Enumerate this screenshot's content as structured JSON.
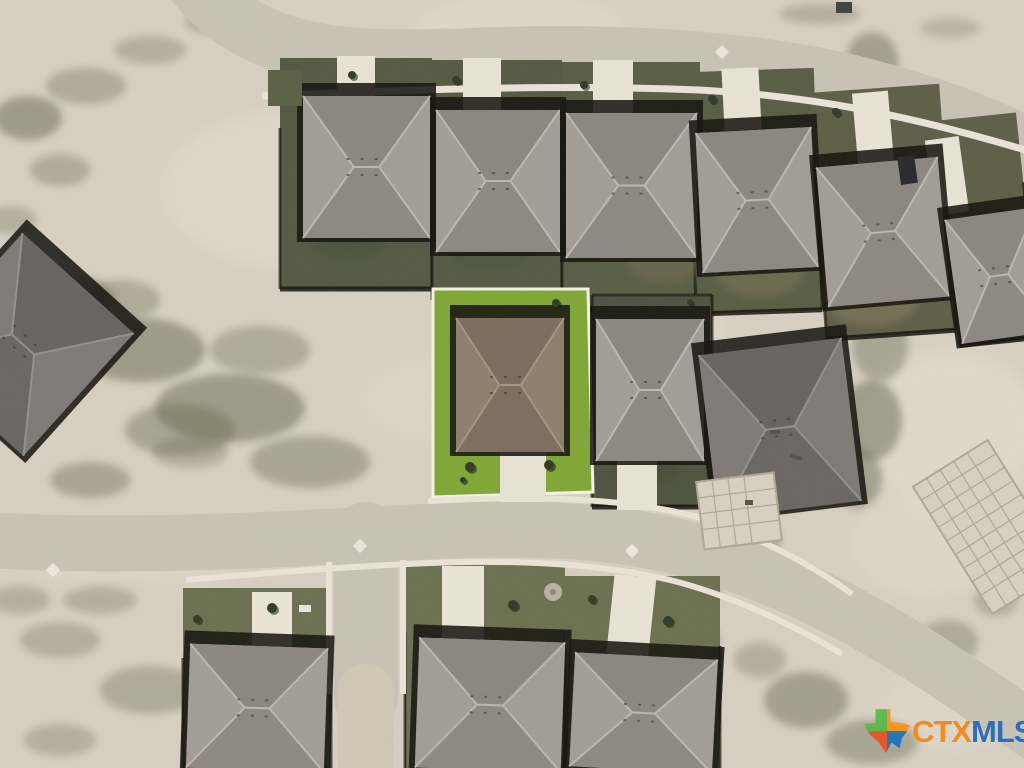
{
  "watermark": {
    "ctx": "CTX",
    "mls": "MLS",
    "ctx_color": "#f28a20",
    "mls_color": "#2e6fba",
    "logo": {
      "green": "#5cb848",
      "orange": "#f7941d",
      "blue": "#1b75bb",
      "red": "#ea5329"
    }
  },
  "palette": {
    "dirt": "#d7d0c3",
    "dirtLight": "#e9e3d6",
    "scrub": "#66664d",
    "road": "#c9c3b6",
    "walk": "#eae5d8",
    "drive": "#e9e4d6",
    "shadow": "#14130e",
    "lawnDark1": "#545942",
    "lawnDark2": "#575c43",
    "lawnDark3": "#5d5e46",
    "lawnMid": "#6b7050",
    "lawnA": "#4e5340",
    "lawnBright": "#7fa735",
    "lotOutline": "#f7f4ea",
    "slab": "#d8d1c3",
    "slabLine": "#b0a795"
  },
  "roofs": {
    "gray": {
      "base": "#a29e96",
      "facet": "#8b877f",
      "ridge": "#bcb8b0"
    },
    "grayDark": {
      "base": "#7e7a74",
      "facet": "#67635e",
      "ridge": "#94908a"
    },
    "brown": {
      "base": "#8f7e6d",
      "facet": "#7b6b5c",
      "ridge": "#a5947e"
    }
  },
  "scene": {
    "roads": [
      {
        "n": "street-top",
        "d": "M 185 -30 C 245 55 330 63 470 57 C 610 51 760 58 875 90 C 950 110 1010 135 1045 158",
        "w": 58,
        "c": "road"
      },
      {
        "n": "street-middle",
        "d": "M -12 540 C 120 548 260 541 420 532 C 560 524 650 534 730 562 C 810 590 880 628 950 675 C 1000 708 1022 723 1048 742",
        "w": 56,
        "c": "road"
      },
      {
        "n": "street-stub",
        "d": "M 366 534 L 366 698",
        "w": 64,
        "c": "road"
      },
      {
        "n": "street-stub-dirt",
        "d": "M 366 692 L 366 772",
        "w": 56,
        "c": "#d2c8b5"
      }
    ],
    "walks": [
      {
        "n": "sidewalk-top",
        "d": "M 262 96 C 400 90 560 84 700 90 C 810 96 905 114 1032 152",
        "w": 7
      },
      {
        "n": "sidewalk-mid-upper",
        "d": "M 428 501 C 560 494 660 500 730 528 C 780 548 822 572 852 594",
        "w": 6
      },
      {
        "n": "sidewalk-mid-lower",
        "d": "M 186 580 C 300 570 360 566 430 563 C 530 559 610 566 670 580 C 730 595 792 624 842 654",
        "w": 6
      },
      {
        "n": "sidewalk-stub-left",
        "d": "M 329 562 L 329 694",
        "w": 6
      },
      {
        "n": "sidewalk-stub-right",
        "d": "M 403 560 L 403 694",
        "w": 6
      }
    ],
    "lightPatches": [
      {
        "x": 300,
        "y": 190,
        "rx": 140,
        "ry": 80,
        "o": 0.45
      },
      {
        "x": 620,
        "y": 340,
        "rx": 110,
        "ry": 70,
        "o": 0.35
      },
      {
        "x": 520,
        "y": 30,
        "rx": 110,
        "ry": 36,
        "o": 0.4
      },
      {
        "x": 90,
        "y": 550,
        "rx": 70,
        "ry": 30,
        "o": 0.35
      },
      {
        "x": 950,
        "y": 710,
        "rx": 70,
        "ry": 40,
        "o": 0.35
      },
      {
        "x": 420,
        "y": 400,
        "rx": 60,
        "ry": 40,
        "o": 0.3
      },
      {
        "x": 180,
        "y": 560,
        "rx": 60,
        "ry": 24,
        "o": 0.3
      },
      {
        "x": 950,
        "y": 430,
        "rx": 90,
        "ry": 80,
        "o": 0.5
      },
      {
        "x": 930,
        "y": 545,
        "rx": 80,
        "ry": 50,
        "o": 0.4
      },
      {
        "x": 995,
        "y": 265,
        "rx": 40,
        "ry": 60,
        "o": 0.4
      }
    ],
    "scrub": [
      {
        "x": 28,
        "y": 118,
        "rx": 34,
        "ry": 22,
        "o": 0.5
      },
      {
        "x": 86,
        "y": 86,
        "rx": 40,
        "ry": 18,
        "o": 0.35
      },
      {
        "x": 150,
        "y": 50,
        "rx": 36,
        "ry": 14,
        "o": 0.3
      },
      {
        "x": 215,
        "y": 22,
        "rx": 30,
        "ry": 12,
        "o": 0.3
      },
      {
        "x": 60,
        "y": 170,
        "rx": 30,
        "ry": 16,
        "o": 0.35
      },
      {
        "x": 10,
        "y": 220,
        "rx": 26,
        "ry": 14,
        "o": 0.3
      },
      {
        "x": 60,
        "y": 300,
        "rx": 55,
        "ry": 26,
        "o": 0.45
      },
      {
        "x": 140,
        "y": 350,
        "rx": 65,
        "ry": 32,
        "o": 0.5
      },
      {
        "x": 230,
        "y": 408,
        "rx": 75,
        "ry": 34,
        "o": 0.5
      },
      {
        "x": 310,
        "y": 462,
        "rx": 60,
        "ry": 26,
        "o": 0.4
      },
      {
        "x": 120,
        "y": 300,
        "rx": 40,
        "ry": 20,
        "o": 0.35
      },
      {
        "x": 260,
        "y": 350,
        "rx": 50,
        "ry": 24,
        "o": 0.35
      },
      {
        "x": 180,
        "y": 430,
        "rx": 55,
        "ry": 26,
        "o": 0.4
      },
      {
        "x": 40,
        "y": 380,
        "rx": 35,
        "ry": 20,
        "o": 0.3
      },
      {
        "x": 90,
        "y": 480,
        "rx": 40,
        "ry": 18,
        "o": 0.4
      },
      {
        "x": 190,
        "y": 452,
        "rx": 38,
        "ry": 16,
        "o": 0.3
      },
      {
        "x": 820,
        "y": 14,
        "rx": 40,
        "ry": 10,
        "o": 0.3
      },
      {
        "x": 950,
        "y": 28,
        "rx": 30,
        "ry": 10,
        "o": 0.25
      },
      {
        "x": 872,
        "y": 62,
        "rx": 26,
        "ry": 30,
        "o": 0.45
      },
      {
        "x": 902,
        "y": 132,
        "rx": 24,
        "ry": 40,
        "o": 0.5
      },
      {
        "x": 928,
        "y": 205,
        "rx": 26,
        "ry": 38,
        "o": 0.45
      },
      {
        "x": 948,
        "y": 268,
        "rx": 24,
        "ry": 30,
        "o": 0.4
      },
      {
        "x": 880,
        "y": 345,
        "rx": 28,
        "ry": 36,
        "o": 0.4
      },
      {
        "x": 872,
        "y": 420,
        "rx": 30,
        "ry": 40,
        "o": 0.5
      },
      {
        "x": 856,
        "y": 478,
        "rx": 26,
        "ry": 30,
        "o": 0.45
      },
      {
        "x": 742,
        "y": 470,
        "rx": 18,
        "ry": 26,
        "o": 0.35
      },
      {
        "x": 760,
        "y": 540,
        "rx": 20,
        "ry": 22,
        "o": 0.4
      },
      {
        "x": 700,
        "y": 585,
        "rx": 22,
        "ry": 16,
        "o": 0.35
      },
      {
        "x": 806,
        "y": 700,
        "rx": 42,
        "ry": 28,
        "o": 0.45
      },
      {
        "x": 872,
        "y": 742,
        "rx": 46,
        "ry": 22,
        "o": 0.4
      },
      {
        "x": 948,
        "y": 642,
        "rx": 30,
        "ry": 22,
        "o": 0.35
      },
      {
        "x": 996,
        "y": 600,
        "rx": 22,
        "ry": 16,
        "o": 0.3
      },
      {
        "x": 760,
        "y": 660,
        "rx": 26,
        "ry": 18,
        "o": 0.3
      },
      {
        "x": 700,
        "y": 640,
        "rx": 20,
        "ry": 14,
        "o": 0.3
      },
      {
        "x": 60,
        "y": 640,
        "rx": 40,
        "ry": 18,
        "o": 0.3
      },
      {
        "x": 150,
        "y": 690,
        "rx": 50,
        "ry": 24,
        "o": 0.35
      },
      {
        "x": 60,
        "y": 740,
        "rx": 36,
        "ry": 16,
        "o": 0.3
      },
      {
        "x": 260,
        "y": 748,
        "rx": 40,
        "ry": 16,
        "o": 0.3
      },
      {
        "x": 20,
        "y": 600,
        "rx": 30,
        "ry": 14,
        "o": 0.3
      },
      {
        "x": 100,
        "y": 600,
        "rx": 36,
        "ry": 14,
        "o": 0.3
      }
    ],
    "lots": [
      {
        "n": "backyard-lot",
        "x": 280,
        "y": 58,
        "w": 152,
        "h": 231,
        "f": "lawnDark1",
        "fence": "sb"
      },
      {
        "n": "backyard-lot",
        "x": 432,
        "y": 60,
        "w": 130,
        "h": 240,
        "f": "lawnDark1",
        "fence": "sb"
      },
      {
        "n": "backyard-lot",
        "x": 562,
        "y": 62,
        "w": 138,
        "h": 248,
        "f": "lawnDark2",
        "fence": "sb"
      },
      {
        "n": "backyard-lot",
        "x": 692,
        "y": 70,
        "w": 126,
        "h": 242,
        "f": "lawnDark2",
        "fence": "sb",
        "rot": -2
      },
      {
        "n": "backyard-lot",
        "x": 818,
        "y": 88,
        "w": 130,
        "h": 247,
        "f": "lawnDark3",
        "fence": "sb",
        "rot": -4
      },
      {
        "n": "backyard-lot",
        "x": 948,
        "y": 116,
        "w": 80,
        "h": 226,
        "f": "lawnDark3",
        "fence": "sb",
        "rot": -6
      },
      {
        "n": "side-lot",
        "x": 592,
        "y": 295,
        "w": 120,
        "h": 212,
        "f": "lawnA",
        "fence": "box"
      },
      {
        "n": "front-lot",
        "x": 183,
        "y": 588,
        "w": 148,
        "h": 180,
        "f": "lawnMid",
        "fence": "s"
      },
      {
        "n": "front-lot",
        "x": 405,
        "y": 562,
        "w": 160,
        "h": 206,
        "f": "lawnMid",
        "fence": "s"
      },
      {
        "n": "front-lot",
        "x": 565,
        "y": 576,
        "w": 155,
        "h": 192,
        "f": "lawnMid",
        "fence": "s"
      }
    ],
    "highlightedLot": {
      "points": "433,289 588,289 593,492 433,497",
      "fill": "lawnBright",
      "stroke": "lotOutline",
      "strokeWidth": 3
    },
    "lawnPatches": [
      {
        "x": 665,
        "y": 262,
        "rx": 38,
        "ry": 22,
        "c": "#776e54",
        "o": 0.5
      },
      {
        "x": 760,
        "y": 272,
        "rx": 44,
        "ry": 26,
        "c": "#7b7257",
        "o": 0.55
      },
      {
        "x": 872,
        "y": 296,
        "rx": 48,
        "ry": 30,
        "c": "#867a5e",
        "o": 0.6
      },
      {
        "x": 918,
        "y": 240,
        "rx": 26,
        "ry": 36,
        "c": "#8a7e62",
        "o": 0.5
      },
      {
        "x": 350,
        "y": 240,
        "rx": 40,
        "ry": 20,
        "c": "#46503a",
        "o": 0.5
      },
      {
        "x": 490,
        "y": 250,
        "rx": 40,
        "ry": 20,
        "c": "#475138",
        "o": 0.45
      },
      {
        "x": 620,
        "y": 190,
        "rx": 30,
        "ry": 30,
        "c": "#4a5340",
        "o": 0.4
      },
      {
        "x": 250,
        "y": 700,
        "rx": 36,
        "ry": 24,
        "c": "#59624a",
        "o": 0.5
      },
      {
        "x": 470,
        "y": 716,
        "rx": 34,
        "ry": 20,
        "c": "#5a6348",
        "o": 0.45
      },
      {
        "x": 660,
        "y": 706,
        "rx": 36,
        "ry": 24,
        "c": "#59624a",
        "o": 0.5
      },
      {
        "x": 520,
        "y": 398,
        "rx": 26,
        "ry": 12,
        "c": "#95bc4e",
        "o": 0.5
      },
      {
        "x": 468,
        "y": 350,
        "rx": 20,
        "ry": 30,
        "c": "#74a02c",
        "o": 0.5
      },
      {
        "x": 648,
        "y": 470,
        "rx": 30,
        "ry": 14,
        "c": "#424a33",
        "o": 0.5
      }
    ],
    "driveways": [
      {
        "x": 337,
        "y": 56,
        "w": 38,
        "h": 42
      },
      {
        "x": 463,
        "y": 58,
        "w": 38,
        "h": 54
      },
      {
        "x": 593,
        "y": 60,
        "w": 40,
        "h": 55
      },
      {
        "x": 723,
        "y": 68,
        "w": 37,
        "h": 62,
        "rot": -3
      },
      {
        "x": 855,
        "y": 92,
        "w": 36,
        "h": 72,
        "rot": -5
      },
      {
        "x": 930,
        "y": 138,
        "w": 34,
        "h": 76,
        "rot": -8
      },
      {
        "x": 500,
        "y": 450,
        "w": 46,
        "h": 52
      },
      {
        "x": 617,
        "y": 458,
        "w": 40,
        "h": 52
      },
      {
        "x": 252,
        "y": 592,
        "w": 40,
        "h": 58
      },
      {
        "x": 442,
        "y": 566,
        "w": 42,
        "h": 76
      },
      {
        "x": 610,
        "y": 576,
        "w": 42,
        "h": 86,
        "rot": 6
      }
    ],
    "houses": [
      {
        "n": "house",
        "x": 303,
        "y": 96,
        "w": 127,
        "h": 142
      },
      {
        "n": "house",
        "x": 436,
        "y": 110,
        "w": 124,
        "h": 142
      },
      {
        "n": "house",
        "x": 566,
        "y": 113,
        "w": 131,
        "h": 145
      },
      {
        "n": "house",
        "x": 699,
        "y": 130,
        "w": 116,
        "h": 140,
        "rot": -3
      },
      {
        "n": "house",
        "x": 822,
        "y": 162,
        "w": 122,
        "h": 140,
        "rot": -5
      },
      {
        "n": "house",
        "x": 953,
        "y": 213,
        "w": 92,
        "h": 125,
        "rot": -8
      },
      {
        "n": "highlighted-house",
        "x": 456,
        "y": 318,
        "w": 108,
        "h": 134,
        "roof": "brown"
      },
      {
        "n": "house",
        "x": 596,
        "y": 319,
        "w": 108,
        "h": 142
      },
      {
        "n": "house-under-construction",
        "x": 708,
        "y": 346,
        "w": 144,
        "h": 164,
        "rot": -7,
        "roof": "grayDark"
      },
      {
        "n": "house",
        "x": 188,
        "y": 646,
        "w": 138,
        "h": 124,
        "rot": 2
      },
      {
        "n": "house",
        "x": 417,
        "y": 640,
        "w": 146,
        "h": 130,
        "rot": 2
      },
      {
        "n": "house",
        "x": 572,
        "y": 656,
        "w": 143,
        "h": 114,
        "rot": 3
      },
      {
        "n": "house-under-construction",
        "x": -52,
        "y": 262,
        "w": 150,
        "h": 165,
        "rot": 42,
        "roof": "grayDark"
      }
    ],
    "slabs": [
      {
        "n": "foundation-slab",
        "x": 946,
        "y": 452,
        "w": 88,
        "h": 150,
        "rot": -32
      },
      {
        "n": "concrete-pad",
        "x": 700,
        "y": 477,
        "w": 78,
        "h": 68,
        "rot": -7
      }
    ],
    "trees": [
      {
        "x": 352,
        "y": 75,
        "r": 4
      },
      {
        "x": 456,
        "y": 80,
        "r": 4
      },
      {
        "x": 584,
        "y": 85,
        "r": 4
      },
      {
        "x": 712,
        "y": 99,
        "r": 4
      },
      {
        "x": 836,
        "y": 112,
        "r": 4
      },
      {
        "x": 470,
        "y": 467,
        "r": 5
      },
      {
        "x": 549,
        "y": 465,
        "r": 5
      },
      {
        "x": 556,
        "y": 303,
        "r": 4
      },
      {
        "x": 272,
        "y": 608,
        "r": 5
      },
      {
        "x": 197,
        "y": 619,
        "r": 4
      },
      {
        "x": 513,
        "y": 605,
        "r": 5
      },
      {
        "x": 592,
        "y": 599,
        "r": 4
      },
      {
        "x": 668,
        "y": 621,
        "r": 5
      },
      {
        "x": 463,
        "y": 480,
        "r": 3
      },
      {
        "x": 690,
        "y": 302,
        "r": 3
      }
    ],
    "diamonds": [
      {
        "x": 722,
        "y": 52
      },
      {
        "x": 360,
        "y": 546
      },
      {
        "x": 53,
        "y": 570
      },
      {
        "x": 632,
        "y": 551
      }
    ],
    "objects": [
      {
        "n": "parked-car",
        "x": 899,
        "y": 156,
        "w": 17,
        "h": 28,
        "rot": -8,
        "c": "#26282a"
      },
      {
        "n": "parked-car",
        "x": 299,
        "y": 605,
        "w": 12,
        "h": 7,
        "c": "#e9e7df"
      },
      {
        "n": "utility-box",
        "x": 279,
        "y": 90,
        "w": 9,
        "h": 9,
        "c": "#22241e"
      },
      {
        "n": "dumpster",
        "x": 836,
        "y": 2,
        "w": 16,
        "h": 11,
        "c": "#3e423a"
      },
      {
        "n": "debris",
        "x": 770,
        "y": 430,
        "w": 10,
        "h": 4,
        "c": "#55524c"
      },
      {
        "n": "debris",
        "x": 790,
        "y": 455,
        "w": 12,
        "h": 4,
        "rot": 20,
        "c": "#55524c"
      },
      {
        "n": "debris",
        "x": 745,
        "y": 500,
        "w": 8,
        "h": 5,
        "c": "#55524c"
      },
      {
        "n": "green-strip",
        "x": 268,
        "y": 70,
        "w": 34,
        "h": 36,
        "c": "#5a5f45"
      }
    ],
    "utilityPad": {
      "x": 553,
      "y": 592,
      "r": 9,
      "c": "#b8b2a5"
    }
  }
}
